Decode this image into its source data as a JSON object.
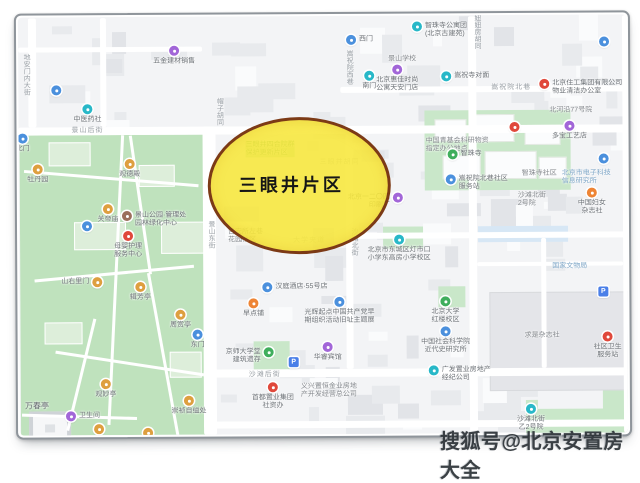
{
  "highlight": {
    "label": "三眼井片区",
    "fill": "#f7e73b",
    "border": "#7c3a16",
    "text_color": "#161616"
  },
  "watermark": {
    "text": "搜狐号@北京安置房大全",
    "color": "#2d3338"
  },
  "map": {
    "park_color": "#bfe2bd",
    "road_color": "#ffffff",
    "building_color": "#e8eaed",
    "pin_colors": {
      "blue": "#4b90dd",
      "teal": "#28b8c8",
      "purple": "#a266d8",
      "amber": "#de9f3f",
      "orange": "#ee8434",
      "red": "#e0483b",
      "green": "#3fae5c",
      "brown": "#9b6f5c",
      "parking": "#4a7fe8"
    },
    "streets": [
      {
        "t": "地安门内大街",
        "x": 22,
        "y": 52,
        "v": 1
      },
      {
        "t": "帽子胡同",
        "x": 215,
        "y": 97,
        "v": 1
      },
      {
        "t": "景山后街",
        "x": 72,
        "y": 124
      },
      {
        "t": "嵩祝院西巷",
        "x": 345,
        "y": 50,
        "v": 1
      },
      {
        "t": "景山东街",
        "x": 206,
        "y": 220,
        "v": 1
      },
      {
        "t": "沙滩北街",
        "x": 349,
        "y": 228,
        "v": 1
      },
      {
        "t": "沙滩后街",
        "x": 248,
        "y": 369
      },
      {
        "t": "北河沿大街",
        "x": 627,
        "y": 120,
        "v": 1
      },
      {
        "t": "嵩祝院北巷",
        "x": 492,
        "y": 83
      },
      {
        "t": "妞妞房胡同",
        "x": 473,
        "y": 15,
        "v": 1
      },
      {
        "t": "三眼井胡同",
        "x": 320,
        "y": 157,
        "faint": 1
      },
      {
        "t": "大学夹道",
        "x": 293,
        "y": 235,
        "faint": 1
      }
    ],
    "areas": [
      {
        "t": [
          "国家文物局"
        ],
        "x": 552,
        "y": 264,
        "c": "inst"
      },
      {
        "t": [
          "求是杂志社"
        ],
        "x": 524,
        "y": 333,
        "c": "plain"
      },
      {
        "t": [
          "北京市电子科技",
          "信息研究所"
        ],
        "x": 562,
        "y": 171,
        "c": "inst"
      },
      {
        "t": [
          "北河沿77号院"
        ],
        "x": 550,
        "y": 108,
        "c": "plain"
      },
      {
        "t": [
          "景山学校"
        ],
        "x": 389,
        "y": 56,
        "c": "plain"
      },
      {
        "t": [
          "中国青基会科研物资",
          "指定办公地点"
        ],
        "x": 426,
        "y": 138,
        "c": "plain"
      },
      {
        "t": [
          "智珠寺社区"
        ],
        "x": 522,
        "y": 171,
        "c": "plain"
      },
      {
        "t": [
          "吉安所左巷",
          "花园社区"
        ],
        "x": 228,
        "y": 228,
        "c": "plain"
      },
      {
        "t": [
          "三眼井四合院群",
          "保护更新片区"
        ],
        "x": 246,
        "y": 141,
        "c": "green"
      },
      {
        "t": [
          "沙滩北街",
          "2号院"
        ],
        "x": 518,
        "y": 193,
        "c": "plain"
      },
      {
        "t": [
          "万春亭"
        ],
        "x": 24,
        "y": 401,
        "c": "dark"
      },
      {
        "t": [
          "义兴置恒金业房地",
          "产开发经营总公司"
        ],
        "x": 300,
        "y": 383,
        "c": "plain"
      }
    ],
    "pois": [
      {
        "x": 57,
        "y": 89,
        "c": "blue"
      },
      {
        "x": 88,
        "y": 108,
        "c": "teal",
        "l": [
          "中医药社"
        ],
        "lp": "b"
      },
      {
        "x": 175,
        "y": 50,
        "c": "purple",
        "l": [
          "五金建材销售"
        ],
        "lp": "b"
      },
      {
        "x": 352,
        "y": 40,
        "c": "blue",
        "l": [
          "西门"
        ],
        "lp": "r"
      },
      {
        "x": 418,
        "y": 27,
        "c": "teal",
        "l": [
          "智珠寺公寓团",
          "(北京古建苑)"
        ],
        "lp": "r"
      },
      {
        "x": 605,
        "y": 43,
        "c": "blue"
      },
      {
        "x": 370,
        "y": 76,
        "c": "teal",
        "l": [
          "南门"
        ],
        "lp": "b"
      },
      {
        "x": 398,
        "y": 70,
        "c": "purple",
        "l": [
          "北京惠佳时尚",
          "公寓天安门店"
        ],
        "lp": "b"
      },
      {
        "x": 447,
        "y": 77,
        "c": "teal",
        "l": [
          "嵩祝寺对面"
        ],
        "lp": "r"
      },
      {
        "x": 545,
        "y": 85,
        "c": "red",
        "l": [
          "北京住工集团有限公司",
          "物业清洁办公室"
        ],
        "lp": "r"
      },
      {
        "x": 570,
        "y": 127,
        "c": "purple",
        "l": [
          "多宝工艺店"
        ],
        "lp": "b"
      },
      {
        "x": 515,
        "y": 128,
        "c": "red"
      },
      {
        "x": 453,
        "y": 155,
        "c": "green",
        "l": [
          "智珠寺"
        ],
        "lp": "r"
      },
      {
        "x": 451,
        "y": 180,
        "c": "blue",
        "l": [
          "嵩祝院北巷社区",
          "服务站"
        ],
        "lp": "r"
      },
      {
        "x": 604,
        "y": 160,
        "c": "blue"
      },
      {
        "x": 592,
        "y": 194,
        "c": "orange",
        "l": [
          "中国妇女",
          "杂志社"
        ],
        "lp": "b"
      },
      {
        "x": 603,
        "y": 293,
        "c": "parking"
      },
      {
        "x": 607,
        "y": 338,
        "c": "red",
        "l": [
          "社区卫生",
          "服务站"
        ],
        "lp": "b"
      },
      {
        "x": 399,
        "y": 240,
        "c": "teal",
        "l": [
          "北京市东城区灯市口",
          "小学东高房小学校区"
        ],
        "lp": "b"
      },
      {
        "x": 398,
        "y": 198,
        "c": "purple",
        "l": [
          "北京一二〇四",
          "印刷厂"
        ],
        "lp": "l"
      },
      {
        "x": 267,
        "y": 287,
        "c": "blue",
        "l": [
          "汉庭酒店·55号店"
        ],
        "lp": "r"
      },
      {
        "x": 253,
        "y": 303,
        "c": "orange",
        "l": [
          "早点铺"
        ],
        "lp": "b"
      },
      {
        "x": 339,
        "y": 302,
        "c": "blue",
        "l": [
          "光辉起点中国共产党早",
          "期组织活动旧址主题展"
        ],
        "lp": "b"
      },
      {
        "x": 268,
        "y": 352,
        "c": "green",
        "l": [
          "京师大学堂",
          "建筑遗存"
        ],
        "lp": "l"
      },
      {
        "x": 327,
        "y": 347,
        "c": "purple",
        "l": [
          "华睿宾馆"
        ],
        "lp": "b"
      },
      {
        "x": 293,
        "y": 362,
        "c": "parking"
      },
      {
        "x": 445,
        "y": 302,
        "c": "green",
        "l": [
          "北京大学",
          "红楼校区"
        ],
        "lp": "b"
      },
      {
        "x": 445,
        "y": 332,
        "c": "blue",
        "l": [
          "中国社会科学院",
          "近代史研究所"
        ],
        "lp": "b"
      },
      {
        "x": 433,
        "y": 371,
        "c": "teal",
        "l": [
          "广发置业房地产",
          "经纪公司"
        ],
        "lp": "r"
      },
      {
        "x": 272,
        "y": 387,
        "c": "red",
        "l": [
          "首都置业集团",
          "社资办"
        ],
        "lp": "b"
      },
      {
        "x": 530,
        "y": 410,
        "c": "teal",
        "l": [
          "沙滩北街",
          "乙2号院"
        ],
        "lp": "b"
      },
      {
        "x": 23,
        "y": 137,
        "c": "blue",
        "l": [
          "北门"
        ],
        "lp": "b"
      },
      {
        "x": 38,
        "y": 168,
        "c": "amber",
        "l": [
          "牡丹园"
        ],
        "lp": "b"
      },
      {
        "x": 130,
        "y": 163,
        "c": "amber",
        "l": [
          "观德殿"
        ],
        "lp": "b"
      },
      {
        "x": 108,
        "y": 208,
        "c": "amber",
        "l": [
          "关帝庙"
        ],
        "lp": "b"
      },
      {
        "x": 127,
        "y": 215,
        "c": "brown",
        "l": [
          "景山公园·管理处",
          "园林绿化中心"
        ],
        "lp": "r"
      },
      {
        "x": 87,
        "y": 225,
        "c": "blue"
      },
      {
        "x": 128,
        "y": 235,
        "c": "red",
        "l": [
          "母婴护理",
          "服务中心"
        ],
        "lp": "b"
      },
      {
        "x": 97,
        "y": 281,
        "c": "amber",
        "l": [
          "山右里门"
        ],
        "lp": "l"
      },
      {
        "x": 140,
        "y": 286,
        "c": "amber",
        "l": [
          "辑芳亭"
        ],
        "lp": "b"
      },
      {
        "x": 180,
        "y": 314,
        "c": "amber",
        "l": [
          "周赏亭"
        ],
        "lp": "b"
      },
      {
        "x": 197,
        "y": 334,
        "c": "blue",
        "l": [
          "东门"
        ],
        "lp": "b"
      },
      {
        "x": 105,
        "y": 383,
        "c": "amber",
        "l": [
          "观妙亭"
        ],
        "lp": "b"
      },
      {
        "x": 70,
        "y": 415,
        "c": "purple",
        "l": [
          "卫生间"
        ],
        "lp": "r"
      },
      {
        "x": 98,
        "y": 428,
        "c": "amber"
      },
      {
        "x": 147,
        "y": 432,
        "c": "amber"
      },
      {
        "x": 188,
        "y": 400,
        "c": "amber",
        "l": [
          "崇祯自缢处"
        ],
        "lp": "b"
      }
    ]
  }
}
